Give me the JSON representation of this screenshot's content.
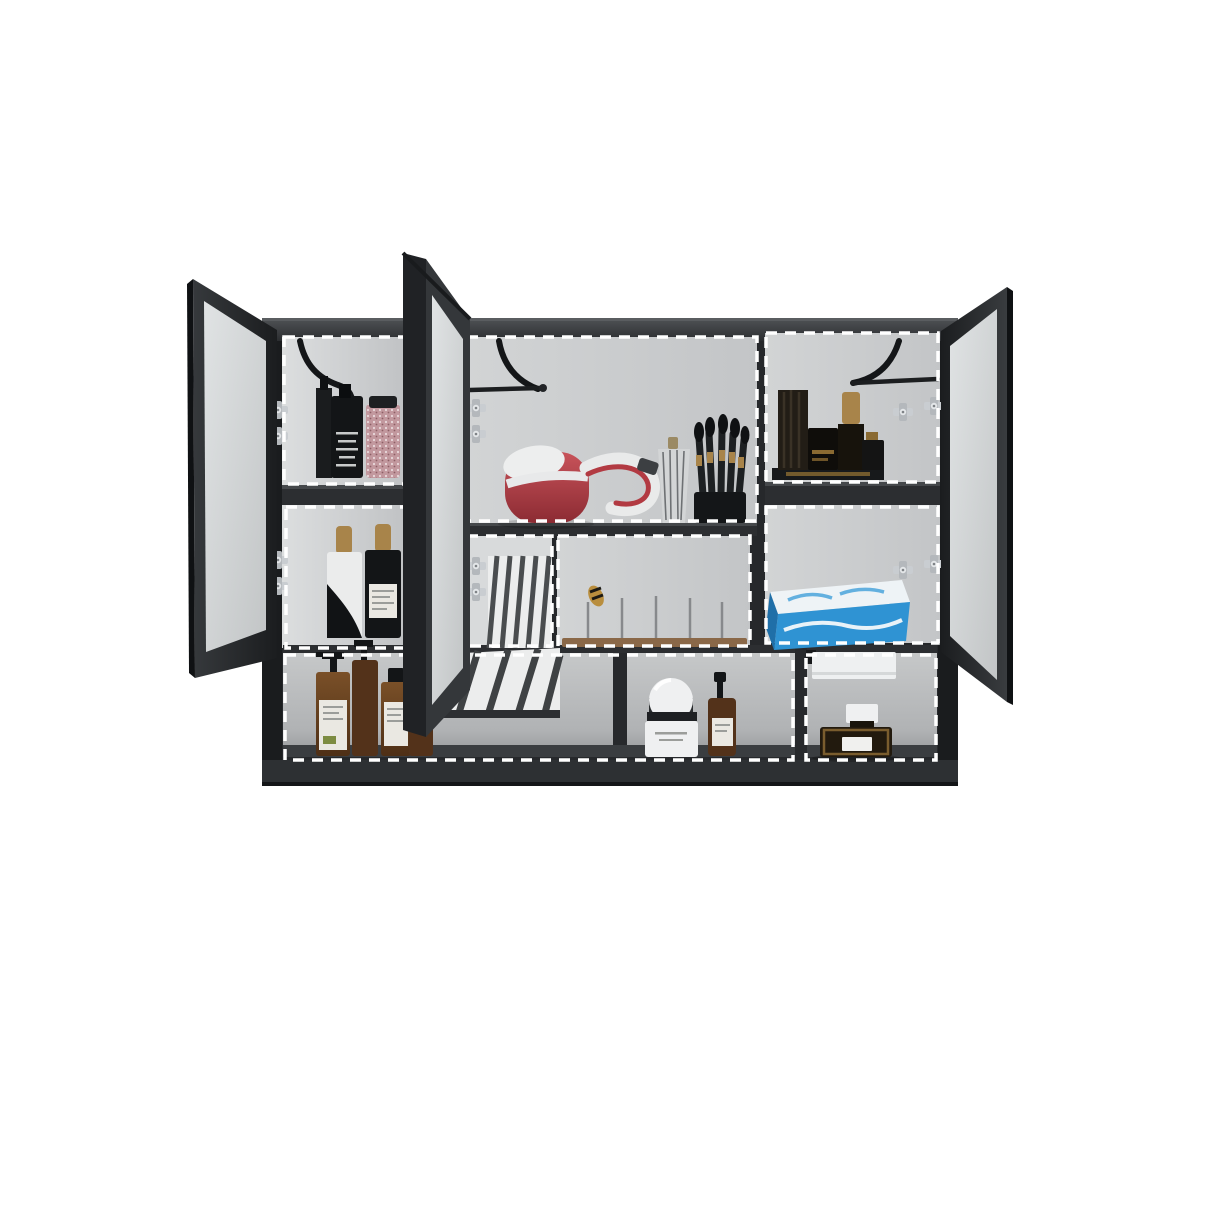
{
  "scene": {
    "type": "product-photo",
    "subject": "Wall-mounted black bathroom mirror cabinet with three open mirrored doors; white dashed outlines highlight nine storage compartments filled with toiletries",
    "compartment_count": 9,
    "door_count": 3
  },
  "palette": {
    "background": "#ffffff",
    "body_dark": "#26282b",
    "body_darker": "#1a1c1e",
    "frame": "#2e3134",
    "mirror_light": "#d9dcdd",
    "wall": "#c8cacc",
    "wall_dark": "#b2b4b6",
    "dash": "#ffffff",
    "chrome": "#c9cdd1",
    "stay": "#141618",
    "amber": "#6b4526",
    "amber_dark": "#53321a",
    "label_paper": "#eae8e2",
    "dryer_red": "#b23a42",
    "white_item": "#eff0f1",
    "blue_box": "#2f93d3",
    "blue_box_top": "#eef3f6",
    "pink_jar": "#c2989e",
    "gold": "#a8844a",
    "wood": "#8a6848",
    "black_item": "#131517",
    "towel": "#eef0f1"
  },
  "labels": {
    "cabinet": "black mirror cabinet body",
    "left_door": "open mirrored door (left)",
    "middle_door": "open mirrored door (middle)",
    "right_door": "open mirrored door (right)",
    "cell_left_top": "compartment: dark serum bottles and pink bath-salts jar",
    "cell_left_bottom": "compartment: dropper bottles with gold caps",
    "cell_center_top": "compartment: red hair dryer, striped bottle and makeup brushes",
    "cell_center_mid_narrow": "compartment: mirror reflection with slatted panel",
    "cell_center_mid_wide": "compartment: wooden tray with metal pins",
    "cell_right_top": "compartment: black cosmetic bottles with gold caps",
    "cell_right_bottom": "compartment: blue tissue box",
    "cell_bottom_left": "open shelf: amber pump bottles, cream jar and spray bottle",
    "cell_bottom_right": "open shelf: hand towel and perfume bottle",
    "hinge": "chrome hinge",
    "stay_arm": "black door stay arm",
    "hair_dryer": "red and white hair dryer",
    "brush_set": "makeup brush set in holder",
    "striped_bottle": "striped decorative bottle",
    "bath_salts": "pink speckled bath-salts jar",
    "serum_bottles": "dark serum bottles",
    "dropper_white": "white dropper bottle with black swoosh",
    "dropper_black": "black dropper bottle with label",
    "cosmetics_group": "black bottles with gold caps on riser",
    "tissue_box": "blue and white tissue box",
    "pin_tray": "wooden tray with upright pins",
    "slat_reflection": "mirrored reflection of slatted panel",
    "pump_bottle": "amber pump bottle",
    "apothecary_bottle": "amber bottle with black cap",
    "cream_jar": "white dome-lid cream jar",
    "spray_bottle": "amber spray bottle",
    "towel": "white hand towel on rail",
    "perfume": "dark perfume bottle with white cap"
  }
}
